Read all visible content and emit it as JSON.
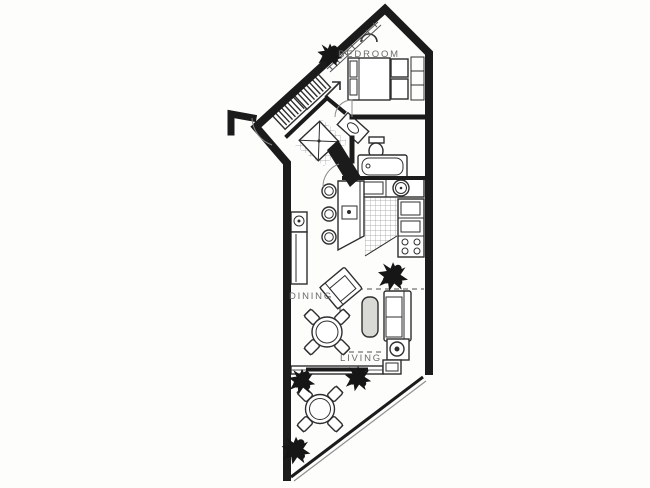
{
  "labels": {
    "bedroom": "BEDROOM",
    "dining": "DINING",
    "living": "LIVING"
  },
  "colors": {
    "paper": "#fdfdfb",
    "wall": "#1b1b1b",
    "line": "#2e2e2e",
    "label": "#6b6b6b",
    "shade": "#d9d9d5",
    "tile_line": "#9a9a9a",
    "plant": "#161616",
    "glass": "#555555"
  },
  "fixtures": {
    "bedroom": [
      "bed",
      "pillows",
      "nightstands",
      "closet-shelves",
      "ceiling-light",
      "window-wall",
      "potted-plant"
    ],
    "entry": [
      "entry-door-swing",
      "hatched-closet",
      "hatched-closet",
      "direction-arrow"
    ],
    "bathroom": [
      "shower-stall",
      "vanity-sink",
      "toilet",
      "bathtub",
      "tiled-floor"
    ],
    "kitchen": [
      "counter",
      "round-sink",
      "cooktop",
      "refrigerator",
      "burner-range",
      "breakfast-bar",
      "bar-sink",
      "bar-stool",
      "bar-stool",
      "bar-stool",
      "tiled-floor",
      "potted-plant"
    ],
    "living_dining": [
      "wet-bar-sink",
      "buffet-cabinet",
      "dining-table",
      "dining-chairs-x4",
      "armchair",
      "coffee-table",
      "sofa",
      "end-table-with-lamp",
      "dashed-area-outline"
    ],
    "balcony": [
      "sliding-window-wall",
      "planter-box",
      "railing",
      "patio-table",
      "patio-chairs-x4",
      "potted-plant",
      "potted-plant",
      "potted-plant"
    ]
  }
}
